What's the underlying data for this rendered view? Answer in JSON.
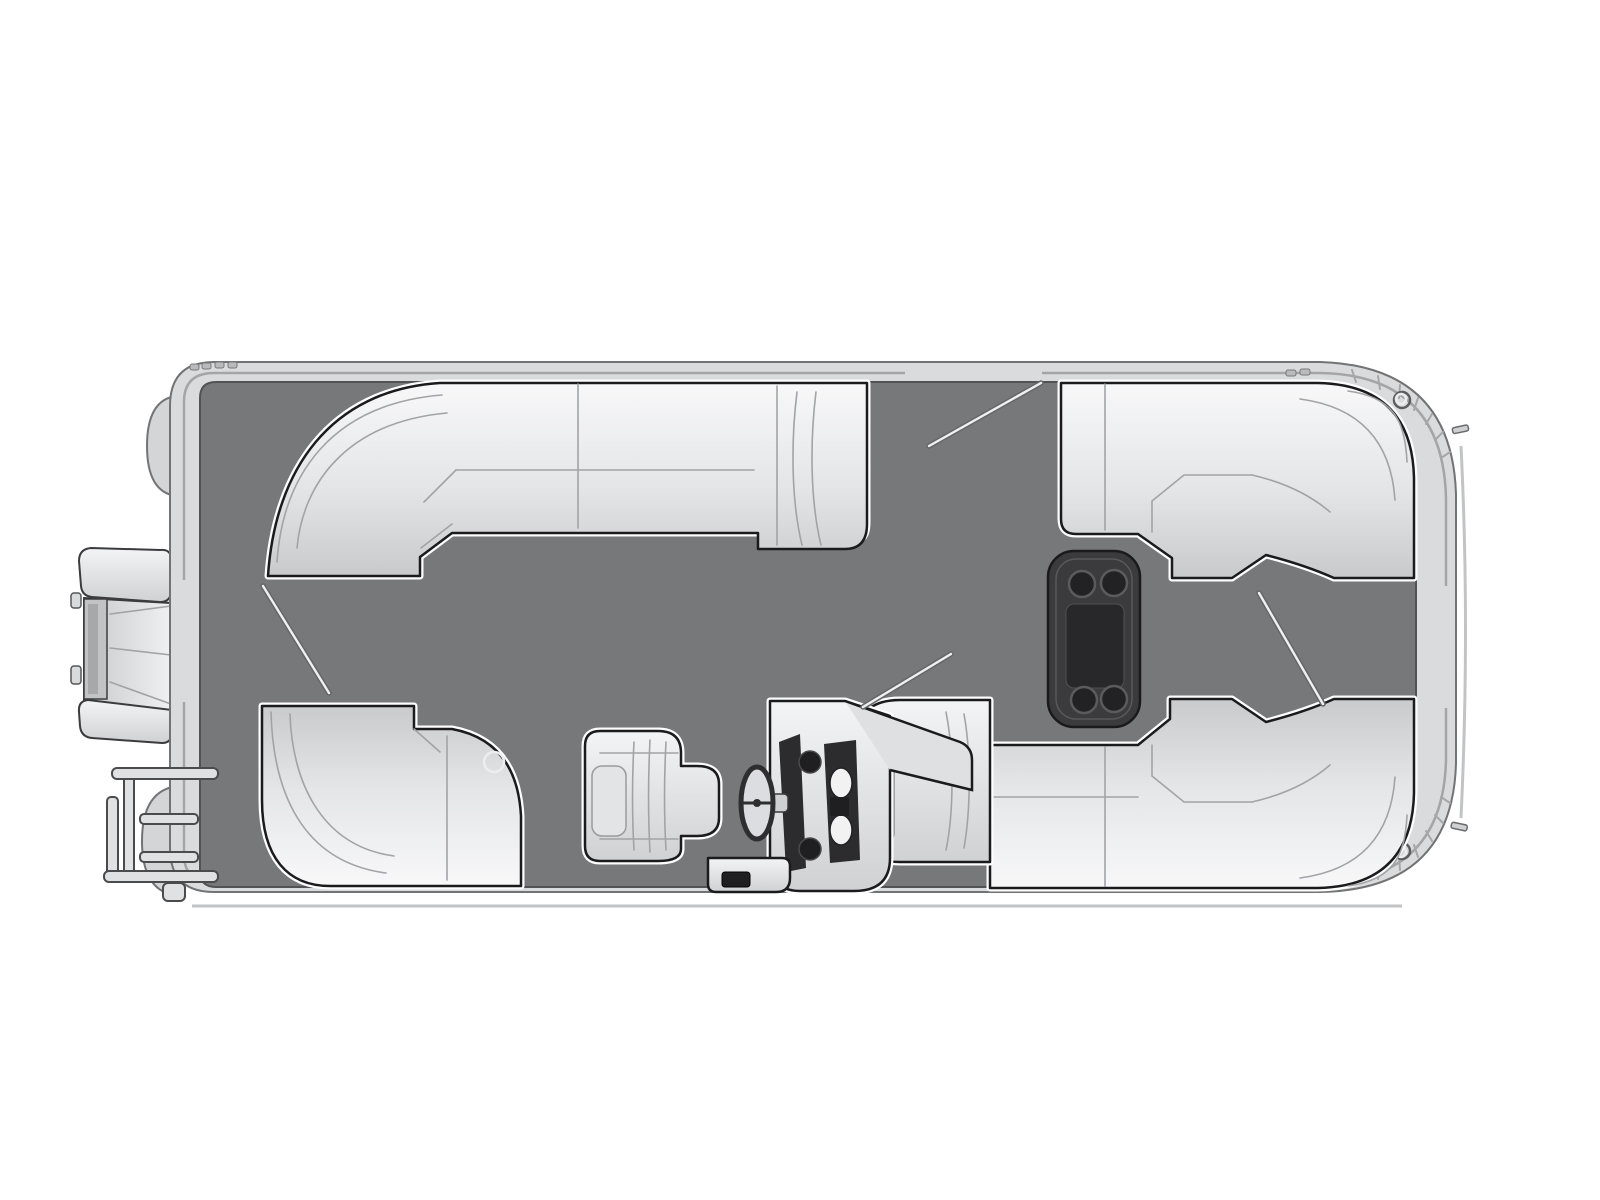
{
  "diagram": {
    "kind": "pontoon-boat-floorplan-top-view",
    "title": "Pontoon boat floor plan, overhead view",
    "orientation": "bow-right-stern-left"
  },
  "colors": {
    "background": "#ffffff",
    "deck": "#77787a",
    "hull_rail": "#dadbdd",
    "rail_line": "#a4a5a7",
    "seat_light": "#f7f7f8",
    "seat_shade": "#cbccce",
    "outline_dark": "#1b1b1d",
    "table_dark": "#3b3b3e",
    "table_recess": "#28282b",
    "console_panel": "#2c2c2f",
    "gauge_dark": "#1f1f22",
    "white_trim": "#fdfdfd"
  },
  "parts": {
    "hull": "rounded pontoon deck with rub rail, hatched bow corners",
    "outboard_motor": "outboard motor on port-stern exterior",
    "boarding_ladder": "stern boarding ladder, exterior lower-left",
    "pontoon_noses": "two pontoon tube ends visible at stern",
    "stern_lounge": "L-shaped wraparound lounge, aft port corner",
    "aft_corner_seat": "quarter-round corner seat with cup holder, aft starboard",
    "bow_lounge_port": "wraparound bow lounge, forward port with armrest notch",
    "bow_lounge_starboard": "wraparound bow lounge, forward starboard with end cap",
    "table": "removable cocktail table",
    "helm_console": "helm console with windshield, gauges and switch panel",
    "captains_chair": "captain's helm chair",
    "steering_wheel": "steering wheel",
    "step_box": "step / storage box beside console",
    "gates": "three entry gates shown open (stern, port side, bow)"
  },
  "counts": {
    "table_cup_holders": 4,
    "gate_swing_lines": 4,
    "helm_round_gauges": 2,
    "helm_white_gauges": 2,
    "bow_cleats": 2,
    "bow_tie_down_rings": 2,
    "ladder_rungs": 2
  }
}
